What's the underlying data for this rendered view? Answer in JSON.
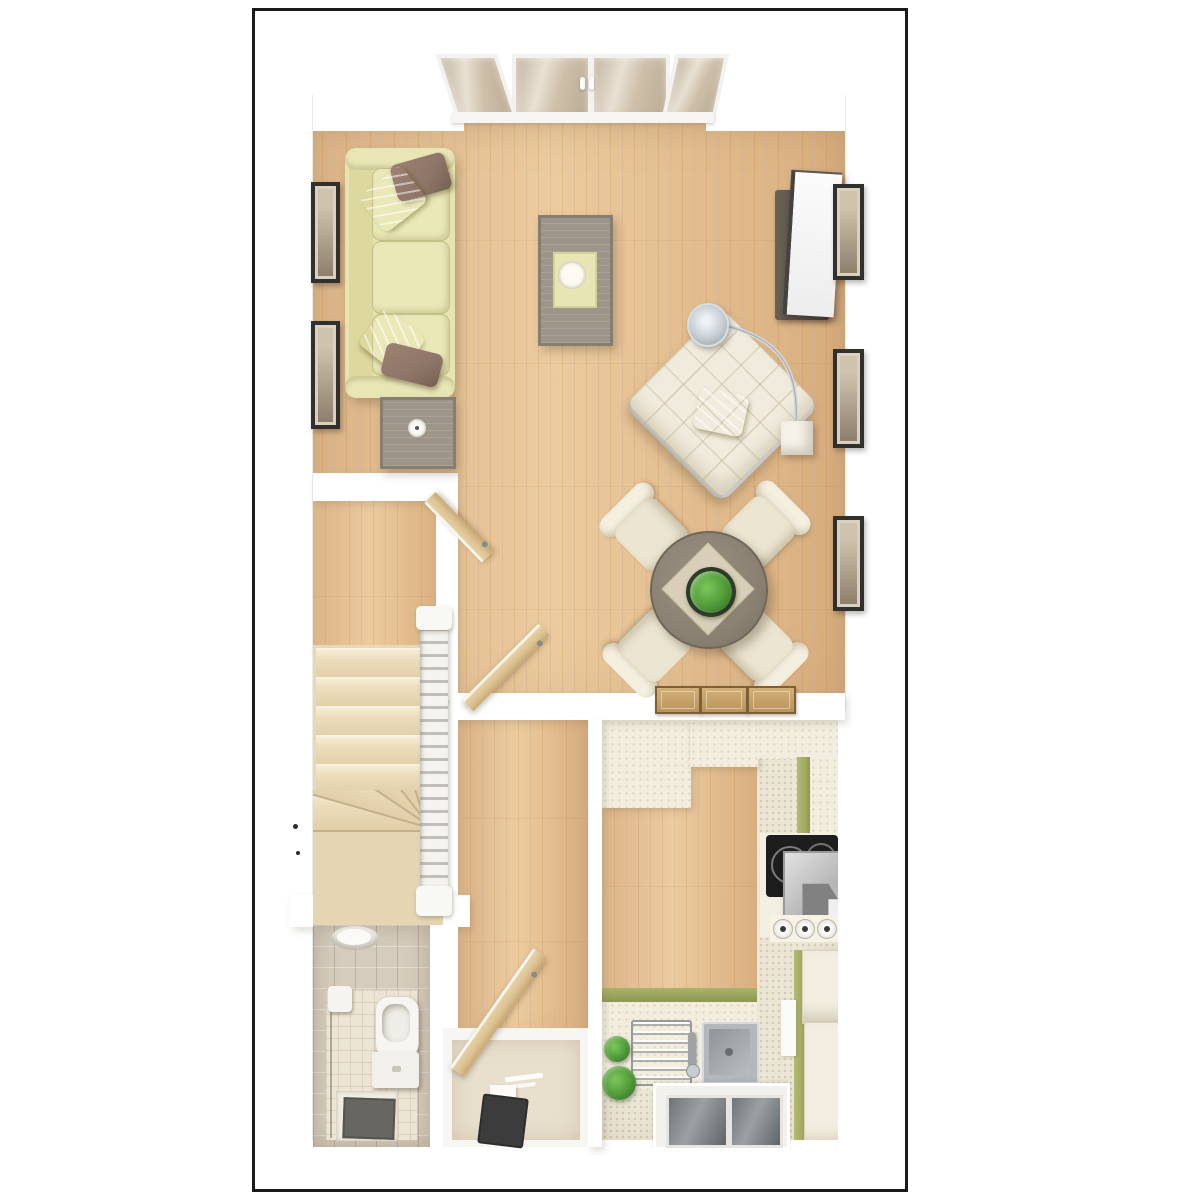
{
  "meta": {
    "description": "3D top-down architectural floor plan render of a ground floor, no text labels visible",
    "visible_text": "none",
    "orientation": "bay doors at top, entrance door and kitchen window at bottom"
  },
  "palette": {
    "page_bg": "#ffffff",
    "border": "#1a1a1a",
    "wall": "#ffffff",
    "wood_base": "#e2bd90",
    "carpet": "#ecdcba",
    "sofa": "#e7e4b0",
    "pillow_green": "#c2cf3a",
    "pillow_brown": "#8e7668",
    "table_gray": "#9d958a",
    "tv_dark": "#57504a",
    "chaise": "#f0ebdd",
    "dining_table": "#8b8173",
    "runner": "#d9cfb8",
    "plant": "#57a23e",
    "chair_cream": "#ece5d1",
    "door_wood": "#dcc392",
    "tile_wall": "#d6ccbd",
    "tile_floor": "#ece4d4",
    "kitchen_floor": "#ece6d6",
    "counter": "#f2edde",
    "cabinet_green": "#a3ab61",
    "hob": "#1d1d1d",
    "steel": "#c0c3c5",
    "glass": "#7a7f82",
    "mat_dark": "#3c3c3c",
    "frame_dark": "#32302c",
    "frame_art": "#d9d0c0"
  },
  "rooms": [
    {
      "id": "living-dining",
      "label": "Living / Dining Room",
      "floor": "oak plank",
      "furniture": [
        "three-seat sofa with 2 green striped and 2 brown cushions",
        "gray side table with bowl",
        "gray coffee table with tray and bowl",
        "TV cabinet with flat TV",
        "arc floor lamp with chrome shade and cube base",
        "cream tufted chaise longue with green cushion",
        "round dining table with diamond runner and plant centrepiece",
        "four cream dining chairs",
        "three wooden trays on half wall",
        "glazed french-door bay",
        "2 framed pictures left wall",
        "3 framed pictures right wall"
      ]
    },
    {
      "id": "hall-stairs",
      "label": "Hall & Stairs",
      "floor": "oak plank / carpeted stairs",
      "furniture": [
        "winder staircase with white banister",
        "two open interior doors"
      ]
    },
    {
      "id": "wc",
      "label": "Cloakroom WC",
      "floor": "beige tile",
      "furniture": [
        "toilet with cistern",
        "wall basin",
        "toilet-roll holder",
        "dark floor mat"
      ]
    },
    {
      "id": "entrance",
      "label": "Entrance Vestibule",
      "floor": "stone",
      "furniture": [
        "open front door",
        "dark doormat",
        "threshold step"
      ]
    },
    {
      "id": "kitchen",
      "label": "Kitchen",
      "floor": "oak plank / stone",
      "furniture": [
        "black hob with extractor",
        "three control knobs",
        "stainless sink with drainer and tap",
        "two potted plants",
        "green-fronted base units",
        "cream worktops",
        "tall fridge-freezer units",
        "window with two panes"
      ]
    }
  ]
}
